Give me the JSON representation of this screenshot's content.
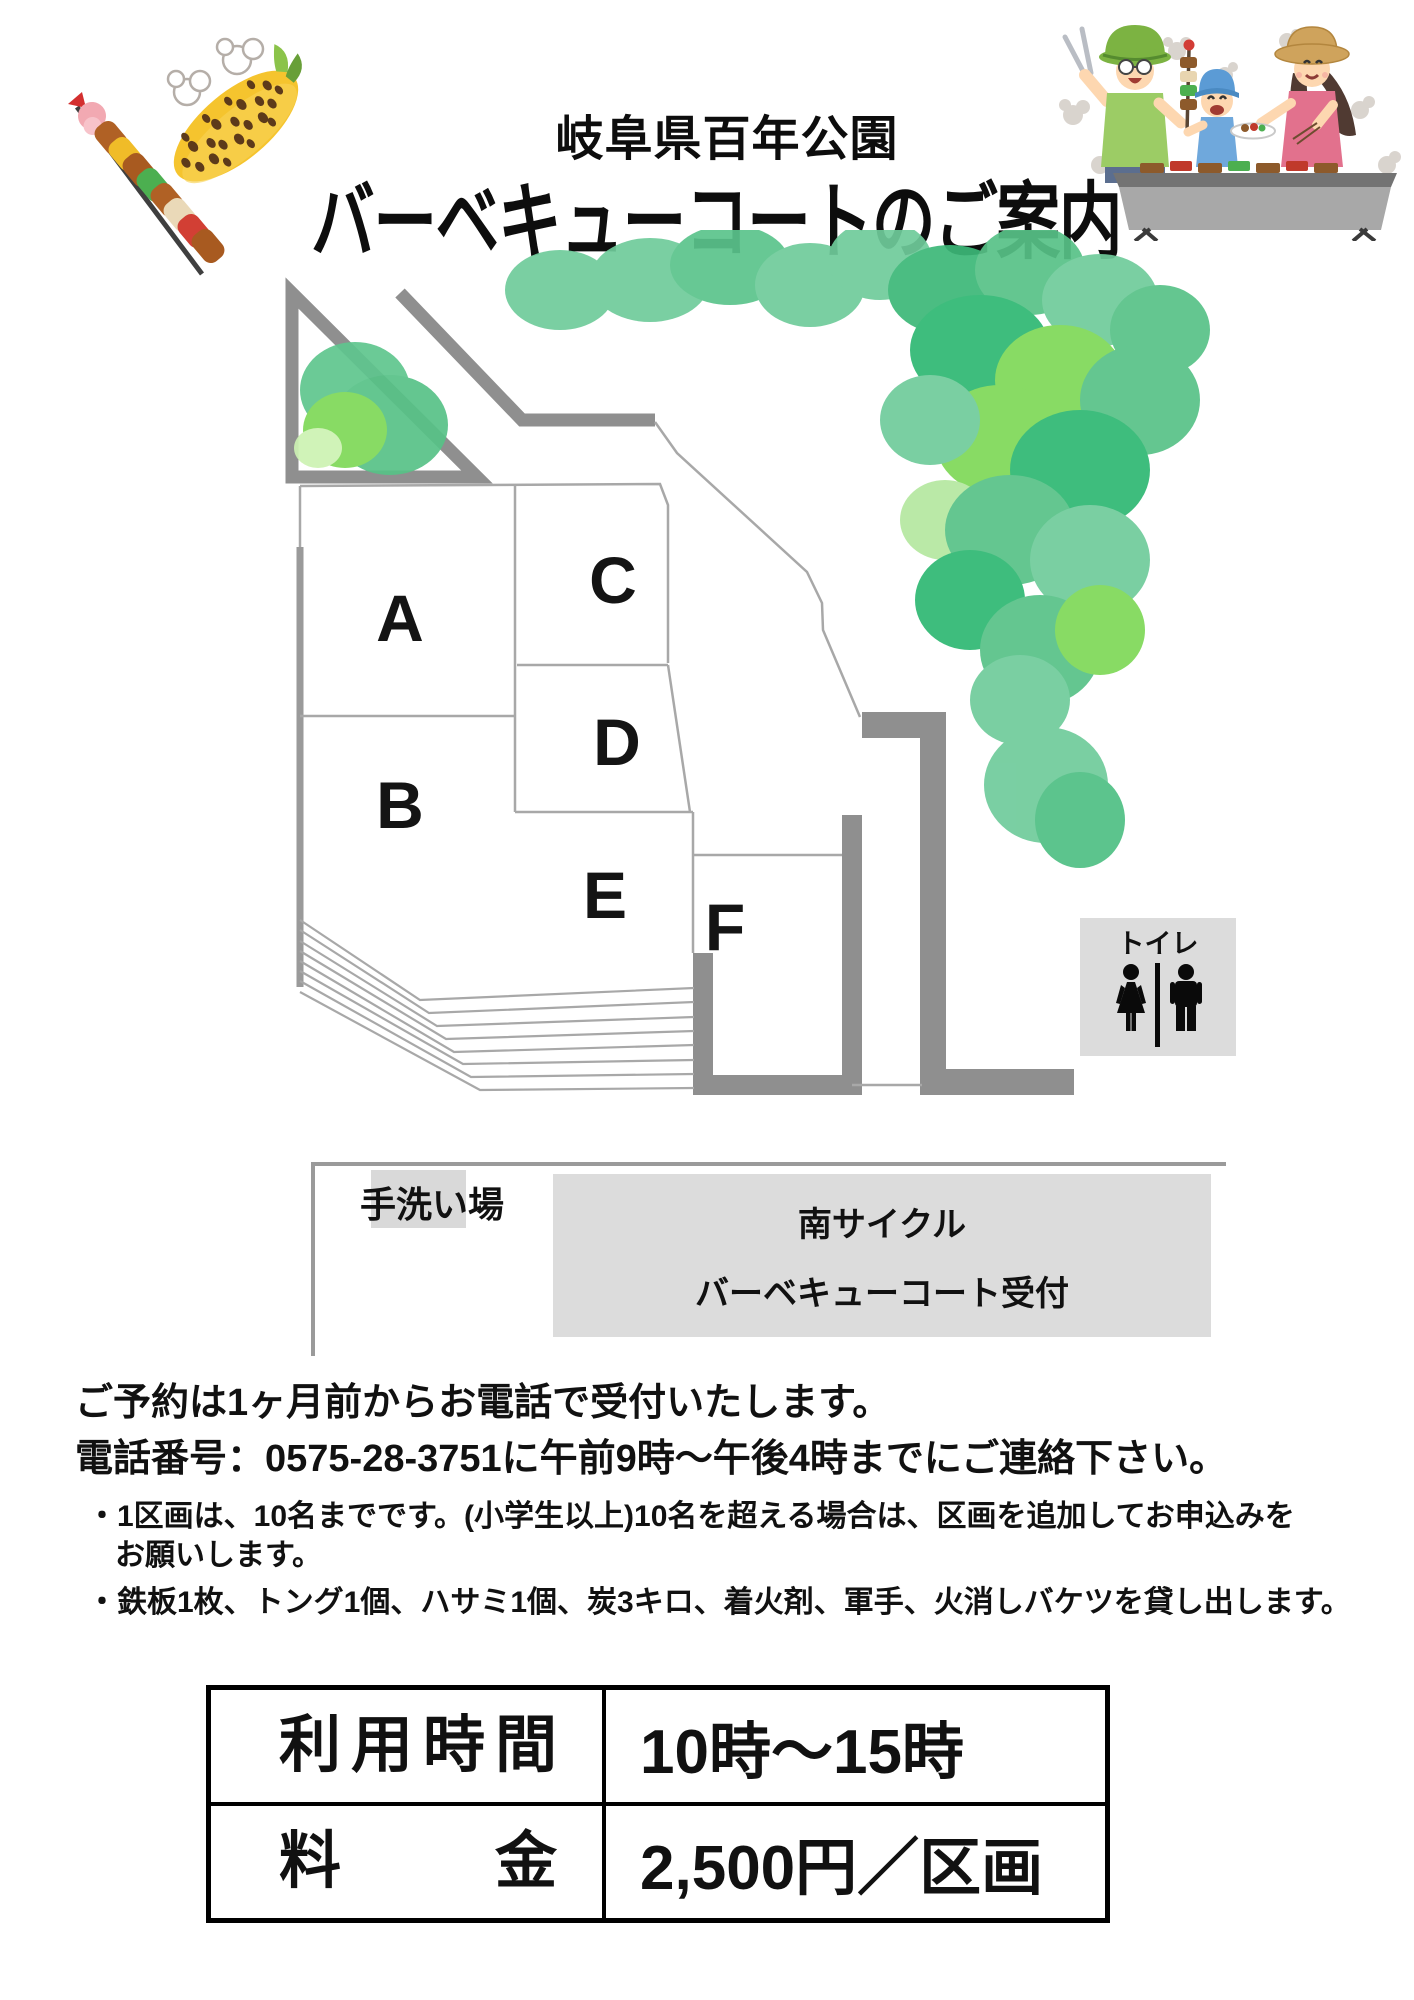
{
  "header": {
    "park_name": "岐阜県百年公園",
    "subtitle": "バーベキューコートのご案内"
  },
  "map": {
    "plots": [
      {
        "label": "A"
      },
      {
        "label": "B"
      },
      {
        "label": "C"
      },
      {
        "label": "D"
      },
      {
        "label": "E"
      },
      {
        "label": "F"
      }
    ],
    "toilet_label": "トイレ",
    "handwash_label": "手洗い場",
    "reception_line1": "南サイクル",
    "reception_line2": "バーベキューコート受付"
  },
  "notes": {
    "line1": "ご予約は1ヶ月前からお電話で受付いたします。",
    "line2": "電話番号：0575-28-3751に午前9時～午後4時までにご連絡下さい。",
    "bullet1_line1": "・1区画は、10名までです。(小学生以上)10名を超える場合は、区画を追加してお申込みを",
    "bullet1_line2": "お願いします。",
    "bullet2": "・鉄板1枚、トング1個、ハサミ1個、炭3キロ、着火剤、軍手、火消しバケツを貸し出します。"
  },
  "info_table": {
    "rows": [
      {
        "label": "利用時間",
        "value": "10時～15時"
      },
      {
        "label": "料金",
        "value": "2,500円／区画"
      }
    ]
  },
  "colors": {
    "wall_gray": "#8f8f8f",
    "panel_gray": "#dcdcdc",
    "tree_green_medium": "#6fcb9b",
    "tree_green_dark": "#2eb872",
    "tree_green_light": "#7ed957",
    "table_border": "#000000"
  }
}
